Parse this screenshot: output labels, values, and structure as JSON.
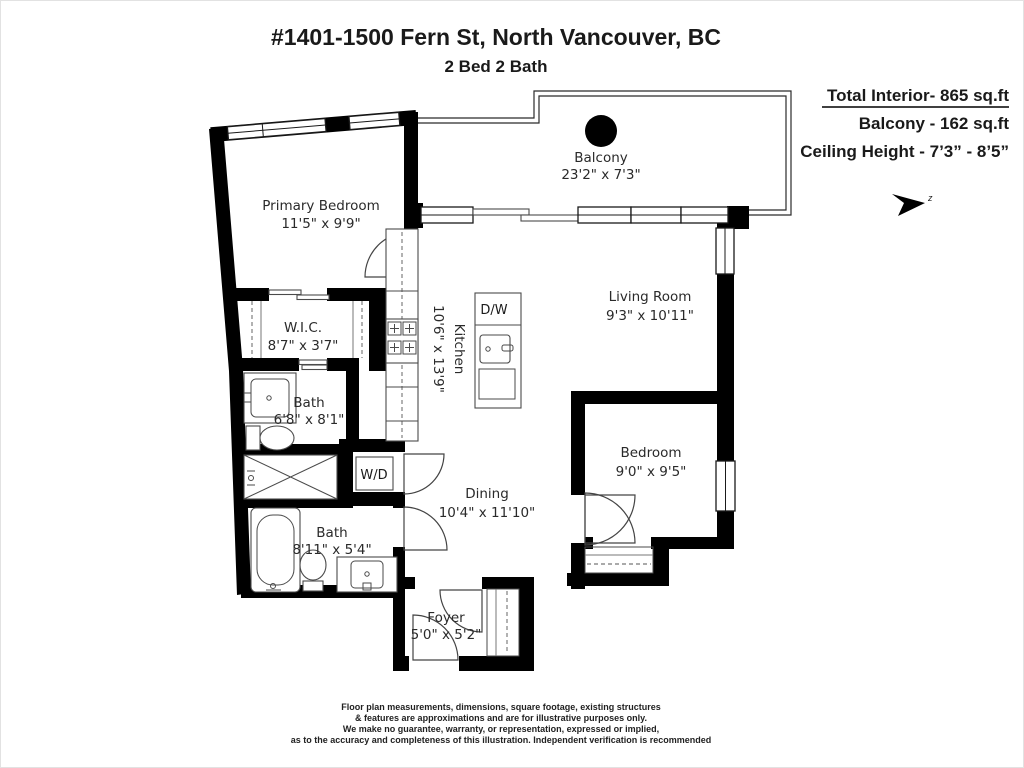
{
  "header": {
    "title": "#1401-1500 Fern St, North Vancouver, BC",
    "subtitle": "2 Bed 2 Bath"
  },
  "stats": {
    "total_interior": "Total Interior- 865 sq.ft",
    "balcony": "Balcony - 162 sq.ft",
    "ceiling_height": "Ceiling Height - 7’3” - 8’5”"
  },
  "compass": {
    "label": "z"
  },
  "rooms": {
    "balcony": {
      "name": "Balcony",
      "dims": "23'2\" x 7'3\""
    },
    "primary_bedroom": {
      "name": "Primary Bedroom",
      "dims": "11'5\" x 9'9\""
    },
    "wic": {
      "name": "W.I.C.",
      "dims": "8'7\" x 3'7\""
    },
    "bath_ensuite": {
      "name": "Bath",
      "dims": "6'8\" x 8'1\""
    },
    "kitchen": {
      "name": "Kitchen",
      "dims": "10'6\" x 13'9\""
    },
    "living_room": {
      "name": "Living Room",
      "dims": "9'3\" x 10'11\""
    },
    "bedroom": {
      "name": "Bedroom",
      "dims": "9'0\" x 9'5\""
    },
    "dining": {
      "name": "Dining",
      "dims": "10'4\" x 11'10\""
    },
    "bath_main": {
      "name": "Bath",
      "dims": "8'11\" x 5'4\""
    },
    "foyer": {
      "name": "Foyer",
      "dims": "5'0\" x 5'2\""
    }
  },
  "appliances": {
    "dishwasher": "D/W",
    "washer_dryer": "W/D"
  },
  "disclaimer": {
    "lines": [
      "Floor plan measurements, dimensions, square footage, existing structures",
      "& features are approximations and are for illustrative purposes only.",
      "We make no guarantee, warranty, or representation, expressed or implied,",
      "as to the accuracy and completeness of this illustration. Independent verification is recommended"
    ]
  },
  "colors": {
    "wall": "#000000",
    "background": "#ffffff",
    "line": "#4a4a4a"
  }
}
